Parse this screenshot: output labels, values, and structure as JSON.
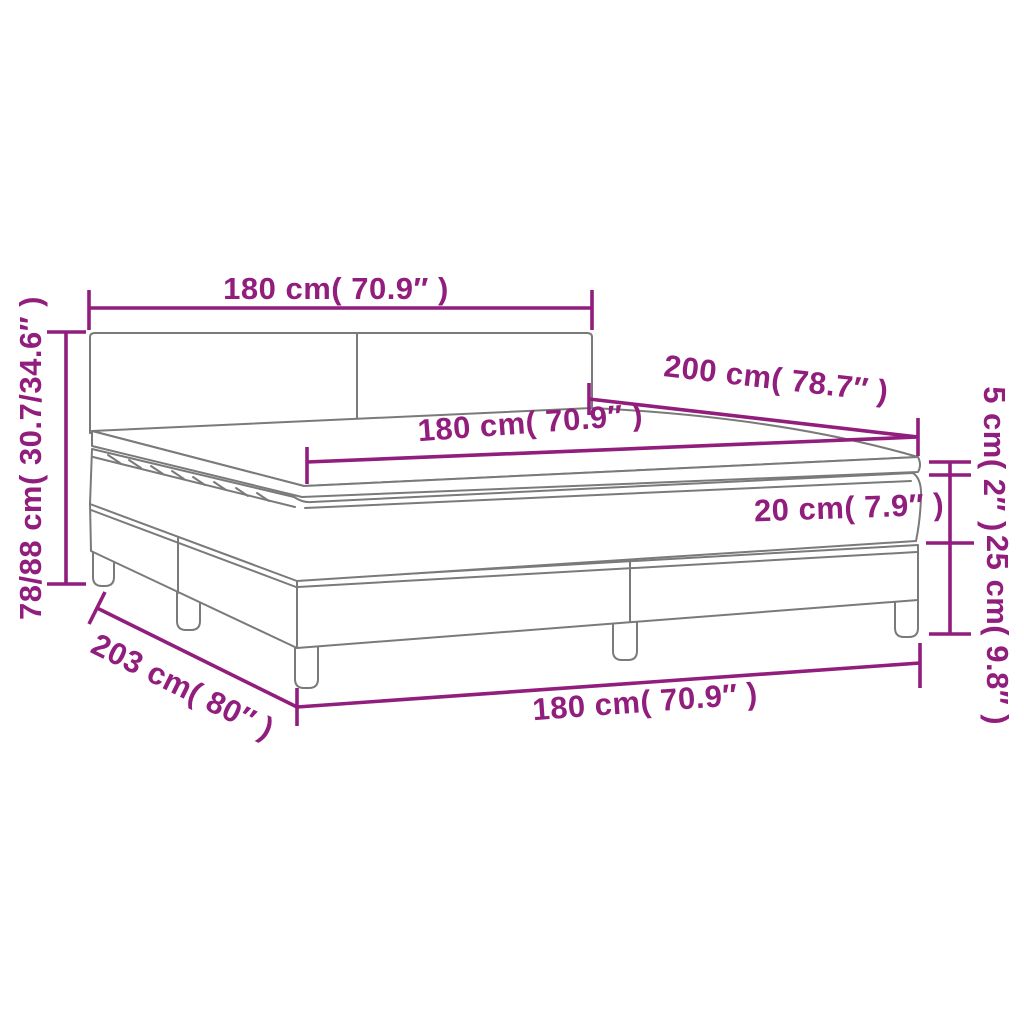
{
  "diagram": {
    "title": "box-spring-bed-dimension-diagram",
    "colors": {
      "annotation": "#911d7d",
      "drawing_outline": "#7a7a7a",
      "background": "#ffffff"
    },
    "dimensions": {
      "headboard_width": "180 cm( 70.9″ )",
      "total_height": "78/88 cm( 30.7/34.6″ )",
      "mattress_length": "200 cm( 78.7″ )",
      "mattress_width": "180 cm( 70.9″ )",
      "topper_height": "5 cm( 2″ )",
      "mattress_height": "20 cm( 7.9″ )",
      "box_height": "25 cm( 9.8″ )",
      "base_length": "203 cm( 80″ )",
      "base_width": "180 cm( 70.9″ )"
    }
  }
}
